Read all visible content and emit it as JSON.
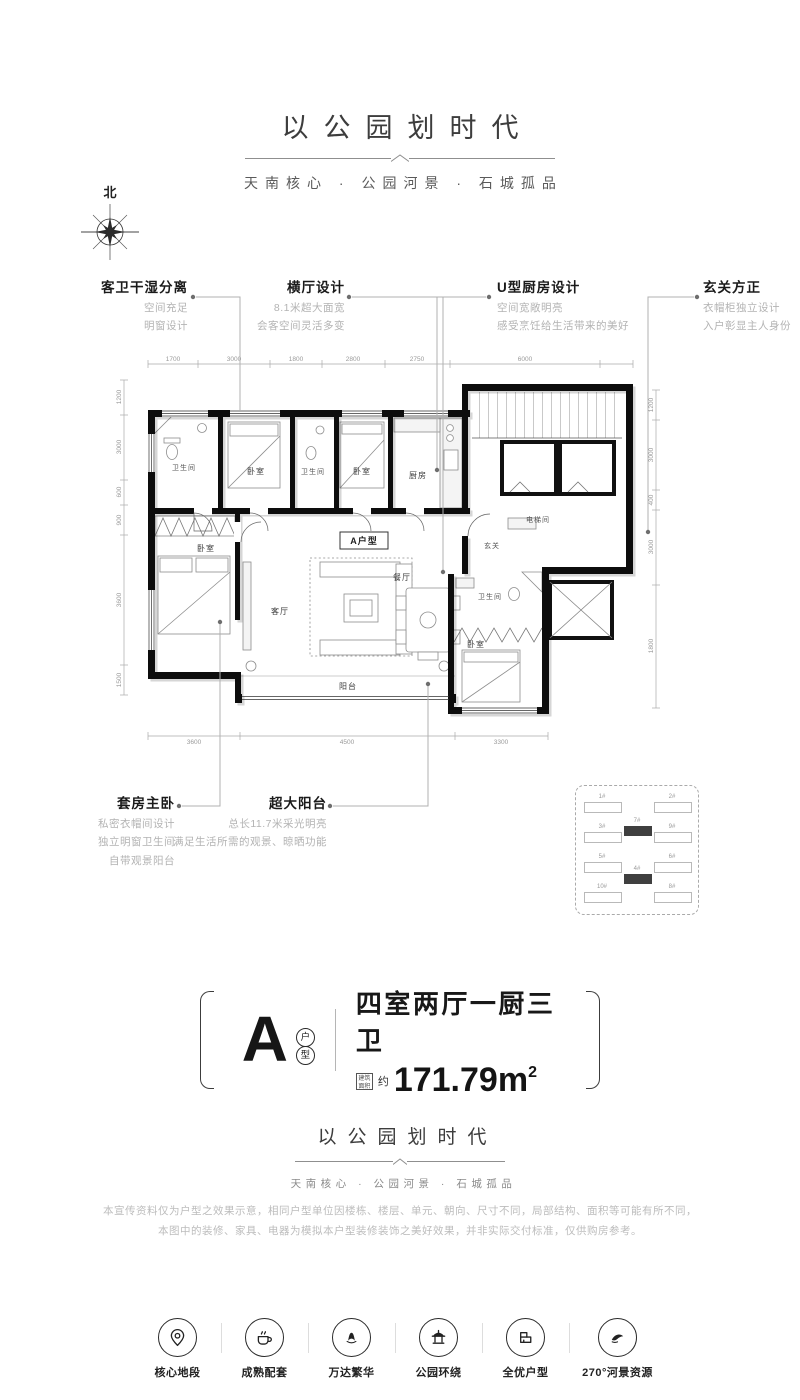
{
  "header": {
    "title": "以公园划时代",
    "subtitle": "天南核心 · 公园河景 · 石城孤品"
  },
  "compass": {
    "label": "北"
  },
  "callouts_top": [
    {
      "title": "客卫干湿分离",
      "lines": [
        "空间充足",
        "明窗设计"
      ]
    },
    {
      "title": "横厅设计",
      "lines": [
        "8.1米超大面宽",
        "会客空间灵活多变"
      ]
    },
    {
      "title": "U型厨房设计",
      "lines": [
        "空间宽敞明亮",
        "感受烹饪给生活带来的美好"
      ]
    },
    {
      "title": "玄关方正",
      "lines": [
        "衣帽柜独立设计",
        "入户彰显主人身份"
      ]
    }
  ],
  "callouts_bottom": [
    {
      "title": "套房主卧",
      "lines": [
        "私密衣帽间设计",
        "独立明窗卫生间",
        "自带观景阳台"
      ]
    },
    {
      "title": "超大阳台",
      "lines": [
        "总长11.7米采光明亮",
        "满足生活所需的观景、晾晒功能"
      ]
    }
  ],
  "plan": {
    "unit_tag": "A户型",
    "rooms": {
      "bath1": "卫生间",
      "bed1": "卧室",
      "bath2": "卫生间",
      "bed2": "卧室",
      "kitchen": "厨房",
      "elevator": "电梯间",
      "foyer": "玄关",
      "living": "客厅",
      "dining": "餐厅",
      "balcony": "阳台",
      "master": "卧室",
      "bath3": "卫生间",
      "bed3": "卧室"
    },
    "dims_top": [
      "1700",
      "3000",
      "1800",
      "2800",
      "2750",
      "6000"
    ],
    "dims_left": [
      "1200",
      "3000",
      "600",
      "900",
      "3600",
      "1500"
    ],
    "dims_right": [
      "1200",
      "3000",
      "400",
      "3000",
      "1800"
    ],
    "dims_bottom": [
      "3600",
      "4500",
      "3300"
    ]
  },
  "keyplan": {
    "buildings": [
      {
        "label": "1#",
        "highlight": false
      },
      {
        "label": "3#",
        "highlight": false
      },
      {
        "label": "5#",
        "highlight": false
      },
      {
        "label": "10#",
        "highlight": false
      },
      {
        "label": "2#",
        "highlight": false
      },
      {
        "label": "9#",
        "highlight": false
      },
      {
        "label": "6#",
        "highlight": false
      },
      {
        "label": "8#",
        "highlight": false
      },
      {
        "label": "7#",
        "highlight": true
      },
      {
        "label": "4#",
        "highlight": true
      }
    ]
  },
  "badge": {
    "letter": "A",
    "circle_chars": [
      "户",
      "型"
    ],
    "layout_text": "四室两厅一厨三卫",
    "area_prefix_box": "建筑面积",
    "approx": "约",
    "area_value": "171.79m",
    "area_sup": "2"
  },
  "footer_brand": {
    "title": "以公园划时代",
    "subtitle": "天南核心 · 公园河景 · 石城孤品"
  },
  "disclaimer": {
    "lines": [
      "本宣传资料仅为户型之效果示意，相同户型单位因楼栋、楼层、单元、朝向、尺寸不同，局部结构、面积等可能有所不同，",
      "本图中的装修、家具、电器为模拟本户型装修装饰之美好效果，并非实际交付标准，仅供购房参考。"
    ]
  },
  "features": [
    {
      "icon": "location-pin-icon",
      "label": "核心地段"
    },
    {
      "icon": "coffee-cup-icon",
      "label": "成熟配套"
    },
    {
      "icon": "wanda-logo-icon",
      "label": "万达繁华"
    },
    {
      "icon": "pavilion-icon",
      "label": "公园环绕"
    },
    {
      "icon": "floorplan-icon",
      "label": "全优户型"
    },
    {
      "icon": "river-view-icon",
      "label": "270°河景资源"
    }
  ]
}
